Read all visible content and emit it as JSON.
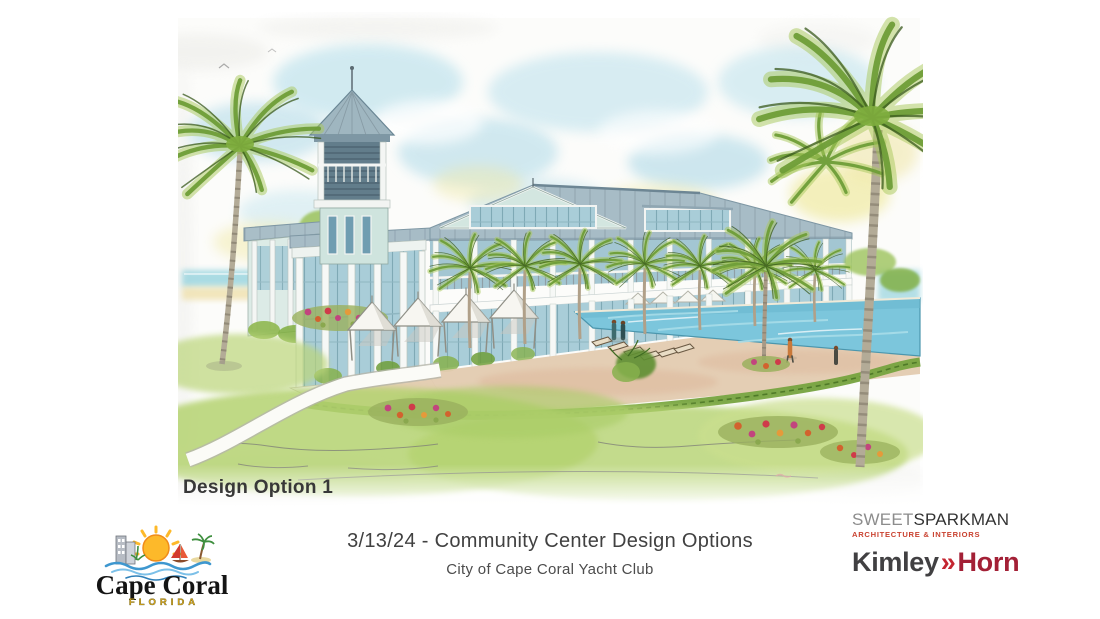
{
  "slide": {
    "rendering": {
      "alt": "Watercolor architectural rendering: two-story coastal community center with a central observation tower and cupola, standing-seam metal roofs, white colonnades and balconies, palm trees, white poolside cabanas, lounge chairs, a curved walkway, flowering landscape beds and a large swimming pool",
      "design_label": "Design Option 1"
    },
    "title": "3/13/24 - Community Center Design Options",
    "subtitle": "City of Cape Coral Yacht Club"
  },
  "footer": {
    "cape_coral_logo": {
      "city": "Cape Coral",
      "state": "FLORIDA"
    },
    "sweet_sparkman_logo": {
      "word1": "SWEET",
      "word2": "SPARKMAN",
      "tagline": "ARCHITECTURE & INTERIORS"
    },
    "kimley_horn_logo": {
      "word1": "Kimley",
      "separator": "»",
      "word2": "Horn"
    }
  },
  "colors": {
    "sky_wash": "#aed9e8",
    "sky_yellow": "#f1e9a8",
    "wall_seafoam": "#d3e6e0",
    "roof_gray": "#a7bcc6",
    "glass_blue": "#a9cdd8",
    "pool_water": "#7cc6dc",
    "deck_tan": "#e3cbb0",
    "lawn_green": "#b5d371",
    "palm_green": "#7fae3e",
    "flower_magenta": "#c2447e",
    "flower_orange": "#d2622e",
    "sparkman_red": "#c9412f",
    "kimley_dark": "#414042",
    "kimley_red": "#a32036",
    "cape_coral_gold": "#eab11d",
    "label_gray": "#383838"
  }
}
